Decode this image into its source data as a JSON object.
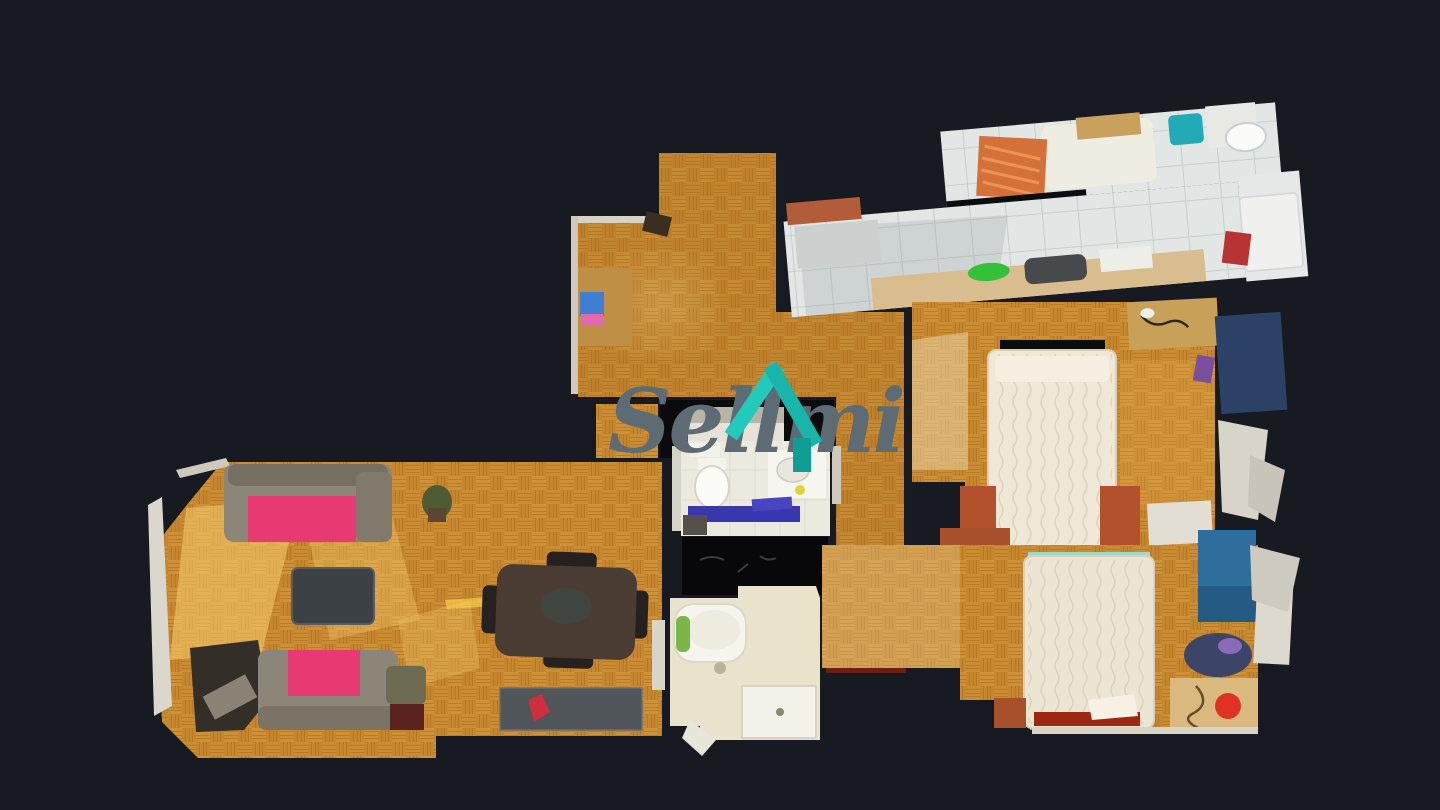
{
  "scene": {
    "type": "3d-dollhouse-floorplan",
    "view": "top-down",
    "background_color": "#171a21",
    "wall_gap_color": "#0b0c0f"
  },
  "watermark": {
    "text": "Sellmi",
    "text_color": "#5d6b74",
    "icon_name": "house-roof-icon",
    "icon_teal": "#1fc4b7",
    "icon_teal_dark": "#0f9e93"
  },
  "rooms": [
    {
      "id": "entry-hall",
      "floor": "parquet"
    },
    {
      "id": "kitchen",
      "floor": "white-tile",
      "items": [
        "counter",
        "dark-sink",
        "green-bowl",
        "fridge",
        "toilet",
        "terracotta-door"
      ]
    },
    {
      "id": "laundry-room",
      "floor": "white-tile",
      "items": [
        "single-bed-orange-blanket",
        "teal-laundry-basket",
        "storage-box"
      ]
    },
    {
      "id": "living-dining-room",
      "floor": "parquet",
      "items": [
        "gray-sofa-pink-throw",
        "second-gray-sofa-pink-throw",
        "dark-armchair",
        "coffee-table",
        "dining-table-with-chairs",
        "sideboard",
        "plant",
        "sun-patches"
      ]
    },
    {
      "id": "bathroom-1",
      "floor": "white-tile",
      "items": [
        "toilet",
        "sink-counter",
        "blue-mat",
        "washing-machine"
      ]
    },
    {
      "id": "bathroom-2",
      "floor": "cream-tile",
      "items": [
        "bathtub",
        "shower",
        "green-mat"
      ]
    },
    {
      "id": "bedroom-1",
      "floor": "parquet",
      "items": [
        "white-double-bed",
        "wood-desk",
        "navy-wardrobe",
        "terracotta-nightstands"
      ]
    },
    {
      "id": "bedroom-2",
      "floor": "parquet",
      "items": [
        "white-double-bed",
        "wood-desk",
        "red-stool",
        "blue-rug",
        "clothes-pile",
        "terracotta-nightstand"
      ]
    }
  ],
  "palette": {
    "parquet": "#c6862e",
    "parquet_line": "#aa7022",
    "tile": "#e2e6e5",
    "tile_line": "#c6cfcf",
    "bath1_floor": "#ece9df",
    "bath2_floor": "#e9e3cc",
    "sofa_gray": "#8c8678",
    "sofa_pink": "#e73a72",
    "counter_tan": "#d9bd8e",
    "terracotta": "#b4512d",
    "navy_wardrobe": "#2c4166",
    "rug_blue": "#2f6e9c",
    "stool_red": "#e03224",
    "mat_blue": "#3937ae",
    "bowl_green": "#35c137",
    "bed_white": "#efe8d7",
    "table_brown": "#4a3b33"
  }
}
